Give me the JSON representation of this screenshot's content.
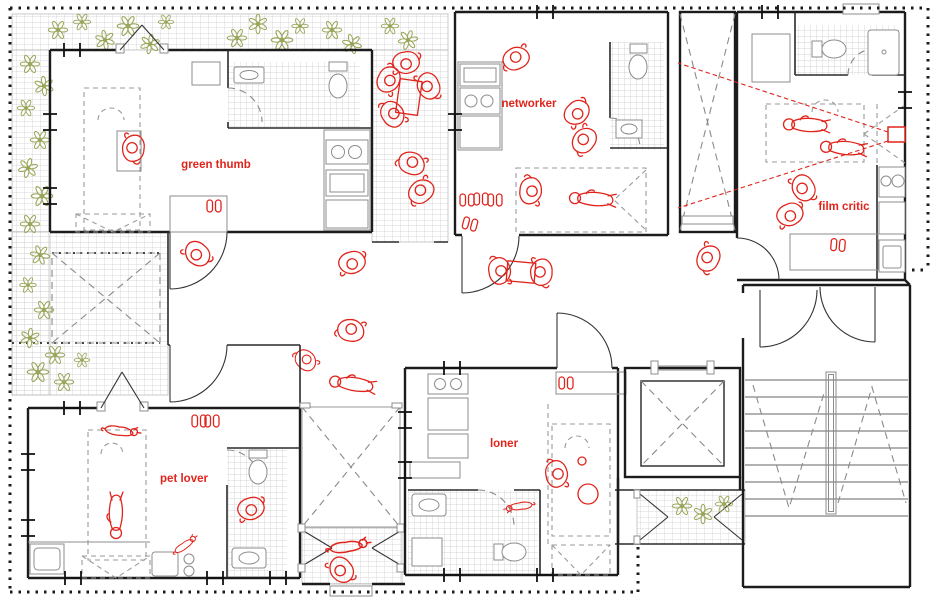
{
  "rooms": [
    {
      "id": "green-thumb",
      "label": "green thumb"
    },
    {
      "id": "networker",
      "label": "networker"
    },
    {
      "id": "film-critic",
      "label": "film critic"
    },
    {
      "id": "pet-lover",
      "label": "pet lover"
    },
    {
      "id": "loner",
      "label": "loner"
    }
  ],
  "colors": {
    "figure_red": "#e0241c",
    "plant_green": "#9aa559",
    "wall_black": "#1c1c1c",
    "tile_gray": "#c9c9c9",
    "furniture_gray": "#8c8c8c"
  }
}
